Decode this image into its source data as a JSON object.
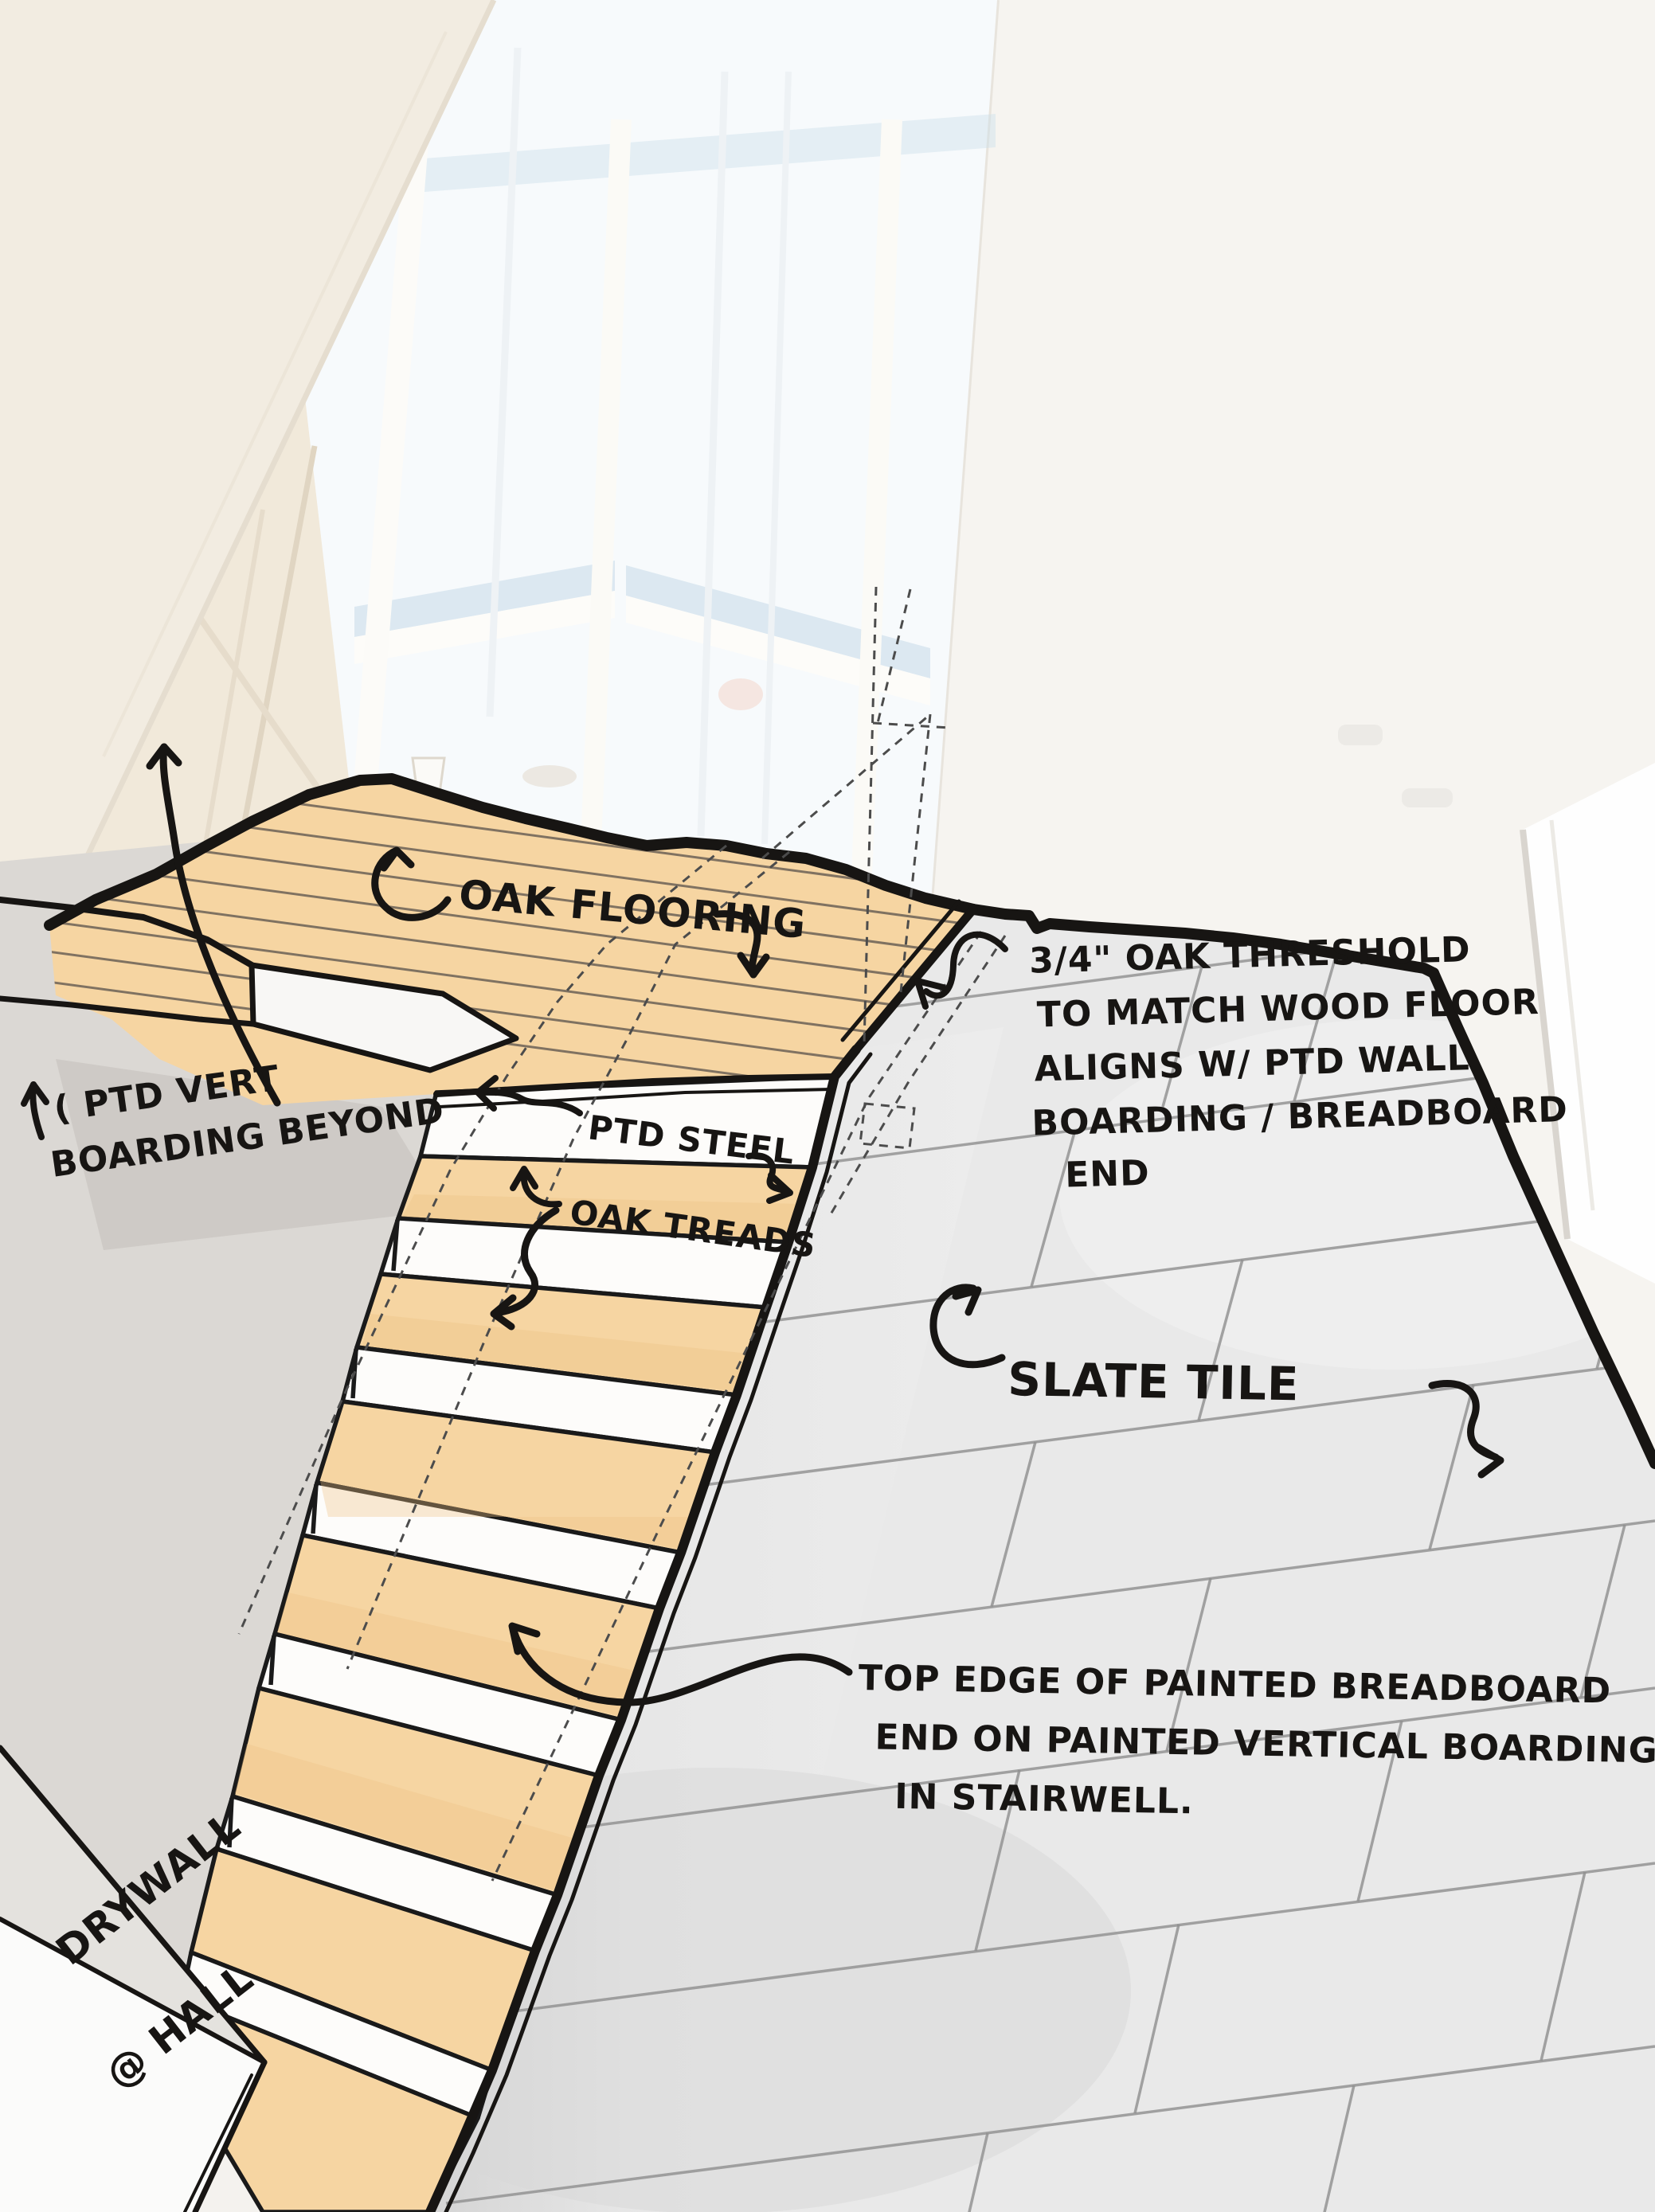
{
  "annotations": {
    "oak_flooring": {
      "label": "OAK FLOORING"
    },
    "threshold_note": {
      "lines": [
        "3/4\" OAK THRESHOLD",
        "TO MATCH WOOD FLOOR",
        "ALIGNS W/ PTD WALL",
        "BOARDING / BREADBOARD",
        "END"
      ]
    },
    "ptd_vert": {
      "lines": [
        "( PTD VERT",
        "BOARDING BEYOND"
      ]
    },
    "ptd_steel": {
      "label": "PTD STEEL"
    },
    "oak_treads": {
      "label": "OAK TREADS"
    },
    "slate_tile": {
      "label": "SLATE TILE"
    },
    "top_edge_note": {
      "lines": [
        "TOP EDGE OF PAINTED BREADBOARD",
        "END ON PAINTED VERTICAL BOARDING",
        "IN  STAIRWELL."
      ]
    },
    "drywall": {
      "lines": [
        "DRYWALL",
        "@ HALL"
      ]
    }
  },
  "colors": {
    "pen": "#171513",
    "oak": "#f6d5a2",
    "oak_line": "#6b6156",
    "tile": "#e9e9e9",
    "tile_line": "#8f8f8f",
    "wall_warm": "#f2ece1",
    "wall_gray": "#dbd8d4",
    "window": "#f7fafc",
    "window_blue": "#cddfec"
  }
}
